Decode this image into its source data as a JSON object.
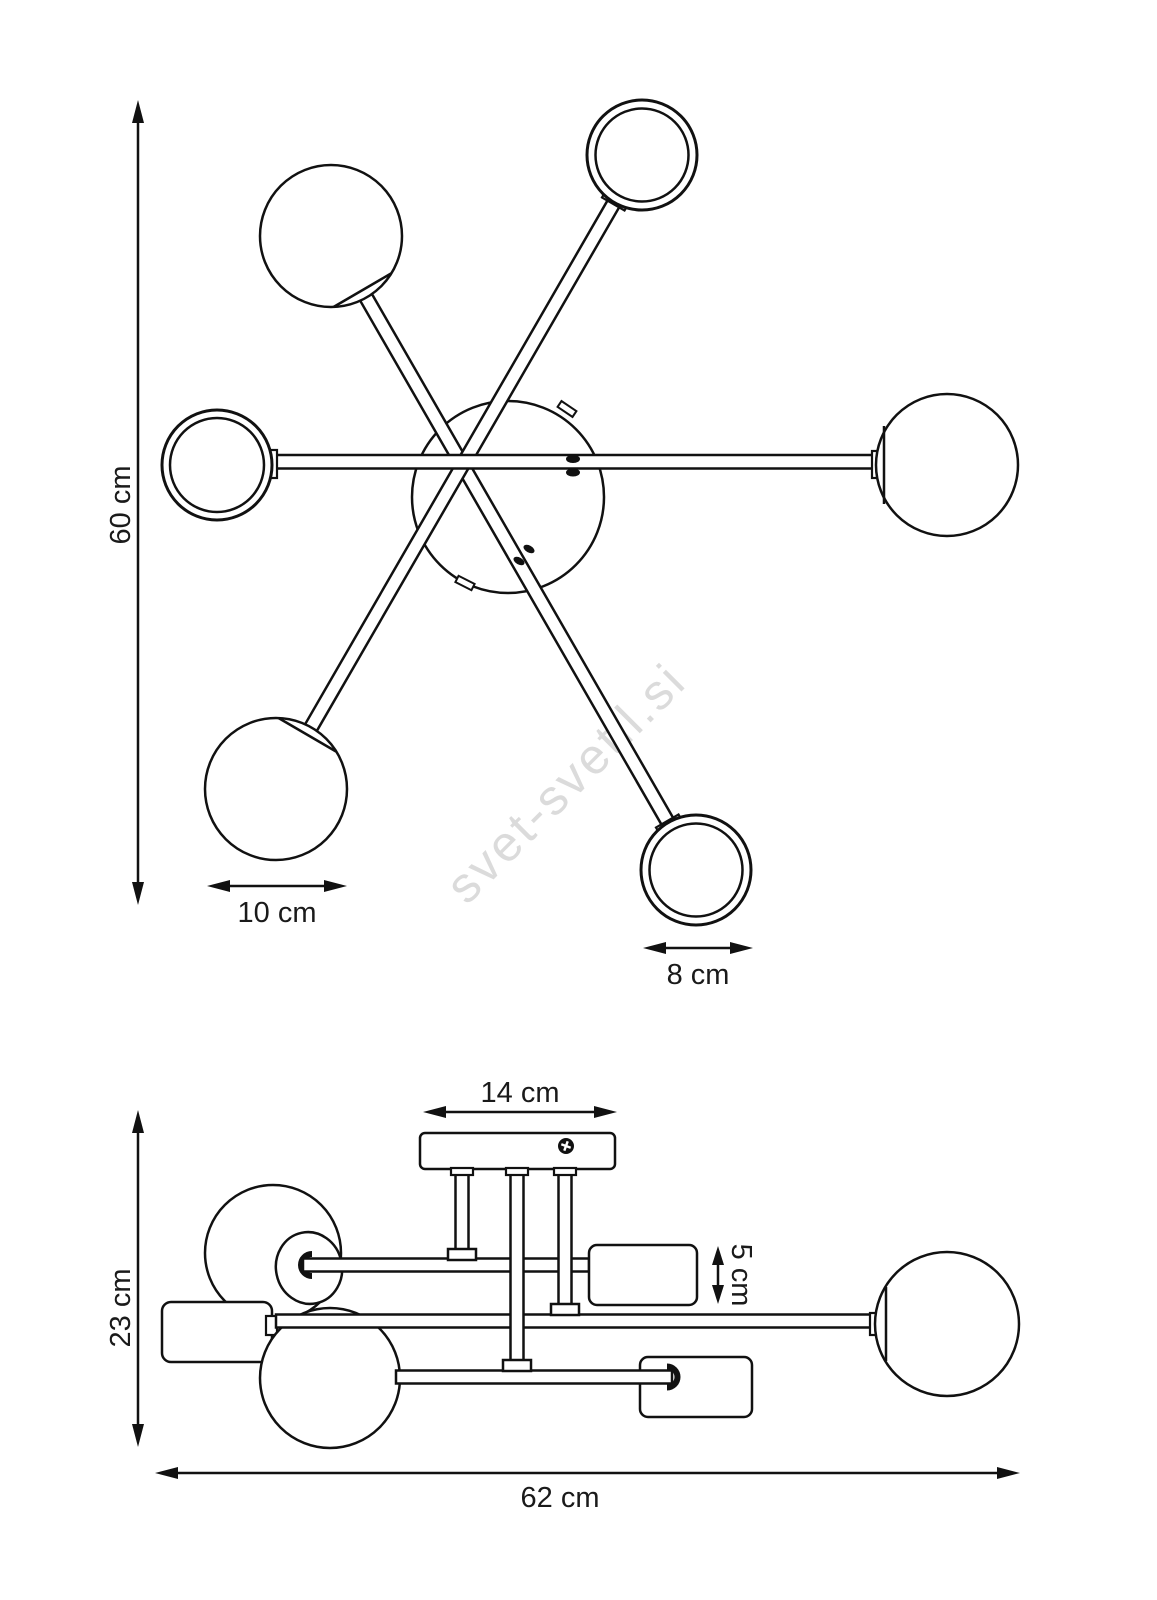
{
  "drawing": {
    "type": "technical-dimension-drawing",
    "subject": "6-arm sputnik ceiling lamp, top view and side view",
    "colors": {
      "line": "#111111",
      "background": "#ffffff",
      "dimension_text": "#1a1a1a"
    },
    "watermark": {
      "text": "svet-svetil.si",
      "color": "#d8d8d8"
    },
    "labels": {
      "top_height": "60 cm",
      "top_globe_large": "10 cm",
      "top_globe_small": "8 cm",
      "canopy_width": "14 cm",
      "shade_height": "5 cm",
      "side_height": "23 cm",
      "side_width": "62 cm"
    }
  }
}
